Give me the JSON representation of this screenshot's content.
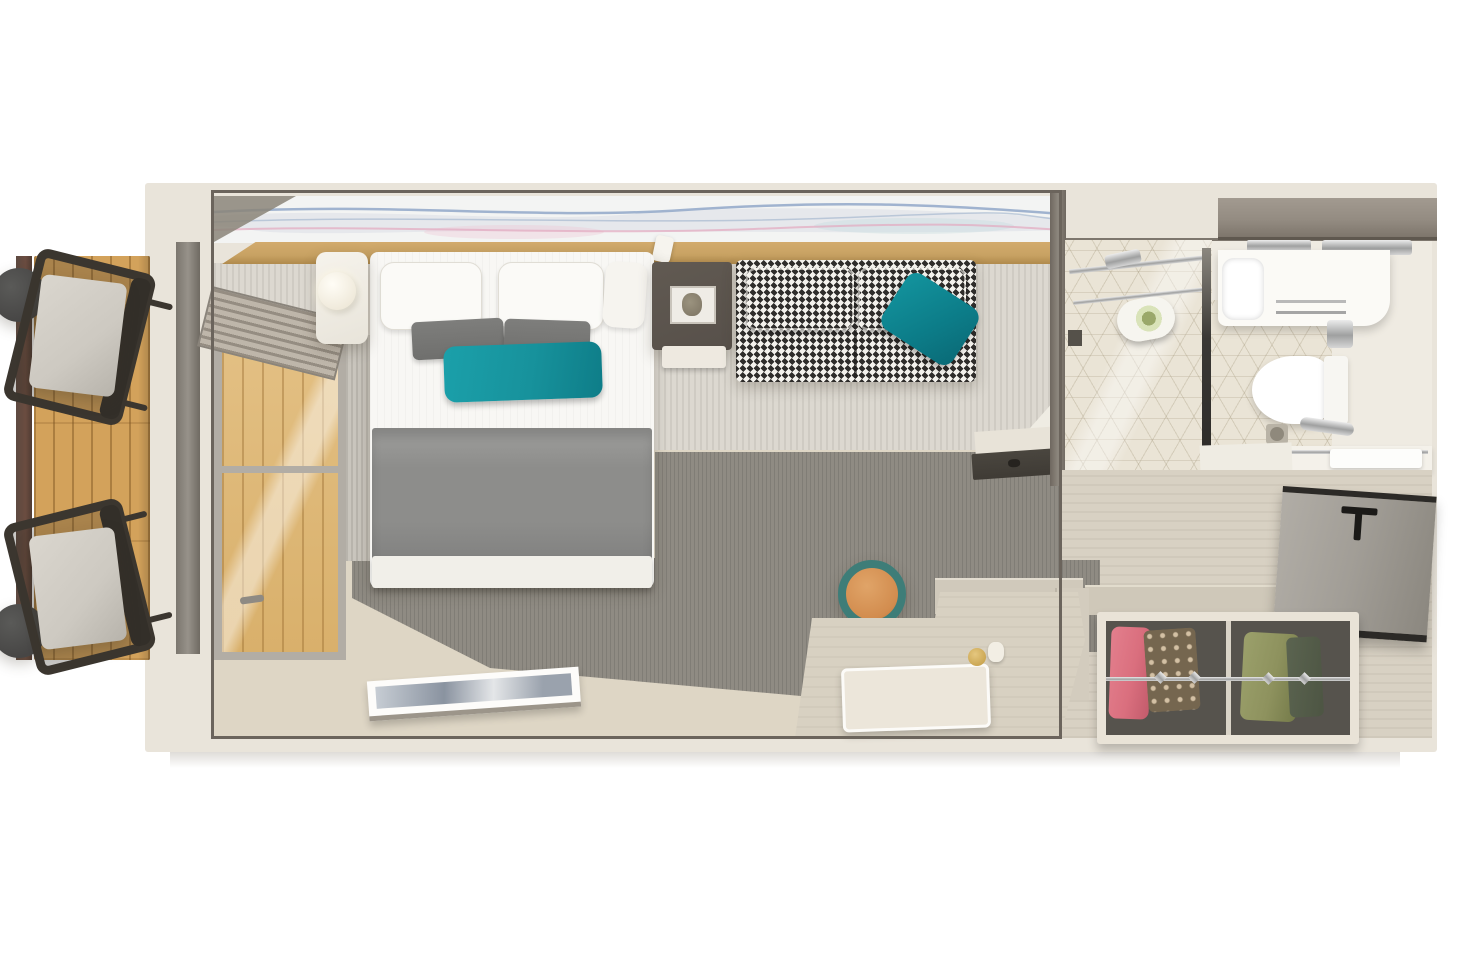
{
  "meta": {
    "type": "3d-floorplan-render",
    "view": "top-down",
    "text_visible": false
  },
  "colors": {
    "wall-cream": "#e9e4da",
    "frame-dark": "#6b645c",
    "mural-base": "#f3f4f3",
    "wave-blue": "#8ba3c6",
    "wave-pink": "#e2a8bf",
    "wood-ledge": "#c8a263",
    "carpet-light": "#dcd8d0",
    "carpet-light-stripe": "#cfcbc3",
    "carpet-dark": "#8f8b83",
    "floor-beige": "#ded6c5",
    "hall-floor": "#d8d1c3",
    "balcony-wood": "#d3a25b",
    "rail-brown": "#6b4c40",
    "chair-frame": "#3b362f",
    "chair-cushion": "#cdc9c1",
    "side-table-dark": "#474645",
    "bed-white": "#f8f7f4",
    "blanket-gray": "#8d8d8b",
    "pillow-gray": "#6f6f6d",
    "accent-teal": "#17929c",
    "sofa-dark": "#2f2d2b",
    "sofa-light": "#f3f1ec",
    "table-brown": "#57504a",
    "bath-floor": "#efebe2",
    "tile-beige": "#eae4d6",
    "counter-wood": "#948c82",
    "fixture-white": "#fbfaf6",
    "chrome": "#b9b9b9",
    "door-gray": "#a19d96",
    "door-edge": "#2c2a27",
    "closet-frame": "#e9e3d7",
    "closet-dark": "#56534d",
    "garment-pink": "#da6f7e",
    "garment-brown": "#75664f",
    "garment-green": "#8e925e",
    "garment-darkgreen": "#4d5543",
    "desk-beige": "#d8d1c2",
    "stool-teal": "#3e7d78",
    "stool-orange": "#d28c4e",
    "towel-green": "#d9e3b9",
    "ledge-dark": "#3f3b35"
  },
  "rooms": {
    "balcony": {
      "items": [
        "wood-deck",
        "railing",
        "round-side-table",
        "round-side-table",
        "lounge-chair",
        "lounge-chair"
      ]
    },
    "bedroom": {
      "items": [
        "abstract-mural",
        "headboard-ledge",
        "double-bed",
        "white-pillows",
        "gray-pillows",
        "teal-throw-pillow",
        "gray-blanket",
        "nightstand",
        "round-lamp",
        "window",
        "roller-blind",
        "side-table",
        "houndstooth-sofa",
        "teal-sofa-pillow",
        "floor-artwork",
        "dark-carpet",
        "striped-carpet",
        "desk",
        "stool",
        "white-tray",
        "wall-hook-ledge"
      ]
    },
    "bathroom": {
      "items": [
        "shower-enclosure",
        "glass-door",
        "rolled-towel",
        "wood-counter",
        "faucet",
        "vanity-counter",
        "sink-basin",
        "towel-rail",
        "soap-dispenser",
        "toilet",
        "grab-bar",
        "floor-drain",
        "towel-shelf",
        "hex-tile-floor"
      ]
    },
    "entry": {
      "items": [
        "entry-door",
        "door-handle",
        "wardrobe",
        "hanging-clothes",
        "clothes-rail",
        "shoes",
        "hall-floor"
      ]
    }
  }
}
